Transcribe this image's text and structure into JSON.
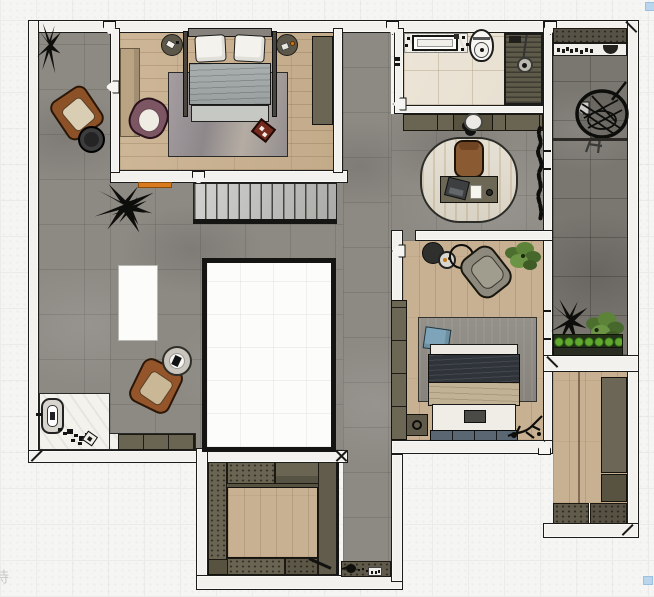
{
  "scene": {
    "type": "apartment-floor-plan-top-down-render",
    "rooms": [
      "living-hall",
      "bedroom-1",
      "bathroom",
      "study-nook",
      "bedroom-2",
      "walk-in-wardrobe",
      "storage-room",
      "laundry-balcony",
      "entry",
      "corridor",
      "stairwell-void"
    ],
    "furniture": [
      "double-bed-1",
      "double-bed-2",
      "leather-armchair-1",
      "leather-armchair-2",
      "plum-armchair",
      "lounge-chair",
      "desk",
      "desk-chair",
      "laptop",
      "notepad",
      "kitchen-island",
      "hanging-egg-chair",
      "toilet",
      "vanity-sink",
      "round-washbasin",
      "shower",
      "stairs",
      "wardrobes",
      "shoe-cabinet",
      "planter-box",
      "potted-plants",
      "side-tables",
      "entry-door-lock"
    ]
  },
  "watermark": {
    "text": "持"
  },
  "markers": {
    "color": "#b9d6ee",
    "positions": [
      {
        "x": 645,
        "y": 2
      },
      {
        "x": 643,
        "y": 576
      }
    ]
  },
  "palette": {
    "background": "#f5f5f3",
    "grid_line": "#ebebe9",
    "wall_fill": "#f2f1ed",
    "wall_line": "#1c1c1a",
    "floor_concrete": "#8d8983",
    "floor_wood": "#c8b192",
    "floor_tile_beige": "#ebe3d5",
    "floor_tile_dark": "#7a7670",
    "floor_marble": "#f4f2ed",
    "cabinet_olive": "#6a6453",
    "rug_gray": "#99928f",
    "leather_brown": "#8a4e2a",
    "chair_plum": "#7d5663",
    "duvet_gray": "#9aa0a0",
    "duvet_navy": "#2f333a",
    "throw_tan": "#c2b295",
    "pillow_blue": "#7da4b8",
    "plant_green": "#5d8338",
    "planter_green": "#61a92e",
    "accent_orange": "#d97a1e",
    "tray_red": "#76291d"
  }
}
